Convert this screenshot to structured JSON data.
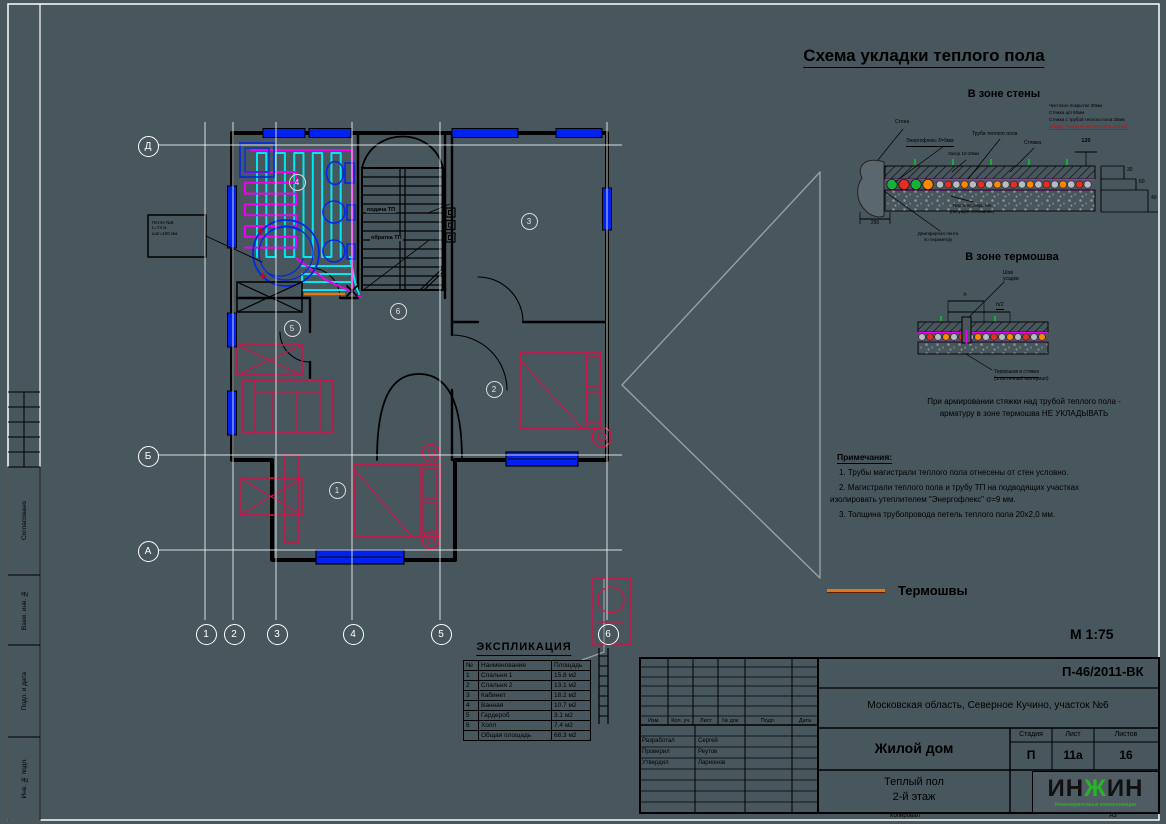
{
  "sheet": {
    "bg": "#48565d",
    "accent_orange": "#e07818",
    "accent_cyan": "#00e8f0",
    "accent_magenta": "#f000f0",
    "accent_blue": "#0022ee",
    "accent_red": "#c81748",
    "logo_green": "#28b428"
  },
  "left_frame": {
    "approved": "Согласовано",
    "stamp_vzam": "Взам. инв. №",
    "stamp_podp": "Подп. и дата",
    "stamp_inv": "Инв. № подл."
  },
  "plan": {
    "axis_cols": [
      "1",
      "2",
      "3",
      "4",
      "5",
      "6"
    ],
    "axis_rows": [
      "Д",
      "Б",
      "А"
    ],
    "room_numbers": [
      "1",
      "2",
      "3",
      "4",
      "5",
      "6"
    ],
    "callout": {
      "line1": "Петля №8.",
      "line2": "L=74 м",
      "line3": "шаг=100 мм"
    },
    "riser_labels": {
      "supply": "подача ТП",
      "return": "обратка ТП"
    }
  },
  "details": {
    "title": "Схема укладки теплого пола",
    "pipe_colors": [
      "#b8bcc0",
      "#e03020",
      "#b8bcc0",
      "#ff8800"
    ],
    "wall_zone": {
      "title": "В зоне стены",
      "wall": "Стена",
      "energoflex": "Энергофлекс δ=9мм",
      "pipe": "Труба теплого пола",
      "gap": "Зазор 10-20мм",
      "screed": "Стяжка",
      "layer1": "Чистовое покрытие 30мм",
      "layer2": "Стяжка ц/п 60мм",
      "layer3": "Стяжка с трубой теплого пола 30мм",
      "layer_total": "Общая толщина чистого пола 120 мм",
      "slab1": "Плита перекрытия",
      "slab2": "(несущее основание)",
      "damper1": "Демпферная лента",
      "damper2": "по периметру",
      "dim120": "120",
      "dim30": "30",
      "dim60": "60",
      "dim40": "40",
      "dim250": "250"
    },
    "seam_zone": {
      "title": "В зоне термошва",
      "dim_h": "h",
      "dim_h2": "h/2",
      "shov1": "Шов",
      "shov2": "усадки",
      "seam1": "Термошов в стяжке",
      "seam2": "(эластичный материал)",
      "note1": "При армировании стяжки над трубой теплого пола -",
      "note2": "арматуру в зоне термошва НЕ УКЛАДЫВАТЬ"
    },
    "notes": {
      "title": "Примечания:",
      "n1": "1. Трубы магистрали теплого пола отнесены от стен условно.",
      "n2": "2. Магистрали теплого пола и трубу ТП на подводящих участках",
      "n3": "изолировать утеплителем \"Энергофлекс\" σ=9 мм.",
      "n4": "3. Толщина трубопровода петель теплого пола 20х2,0 мм."
    },
    "legend_thermal": "Термошвы",
    "scale": "М 1:75"
  },
  "explication": {
    "title": "ЭКСПЛИКАЦИЯ",
    "headers": [
      "№",
      "Наименование",
      "Площадь"
    ],
    "rows": [
      [
        "1",
        "Спальня 1",
        "15.8 м2"
      ],
      [
        "2",
        "Спальня 2",
        "13.1 м2"
      ],
      [
        "3",
        "Кабинет",
        "18.2 м2"
      ],
      [
        "4",
        "Ванная",
        "10.7 м2"
      ],
      [
        "5",
        "Гардероб",
        "3.1 м2"
      ],
      [
        "6",
        "Холл",
        "7.4 м2"
      ]
    ],
    "total": [
      "",
      "Общая площадь",
      "68.3 м2"
    ]
  },
  "titleblock": {
    "doc_number": "П-46/2011-ВК",
    "location": "Московская область, Северное Кучино, участок №6",
    "object_name": "Жилой дом",
    "sheet_name1": "Теплый пол",
    "sheet_name2": "2-й этаж",
    "stage_label": "Стадия",
    "list_label": "Лист",
    "lists_label": "Листов",
    "stage": "П",
    "list": "11а",
    "lists": "16",
    "header_cols": [
      "Изм.",
      "Кол. уч.",
      "Лист",
      "№ док.",
      "Подп.",
      "Дата"
    ],
    "sign_rows": [
      [
        "Разработал",
        "Сергей"
      ],
      [
        "Проверил",
        "Реутов"
      ],
      [
        "Утвердил",
        "Ларионов"
      ]
    ],
    "copied": "Копировал",
    "format": "А3",
    "logo": "ИНЖИН",
    "logo_sub": "Инжиниринговые коммуникации"
  }
}
